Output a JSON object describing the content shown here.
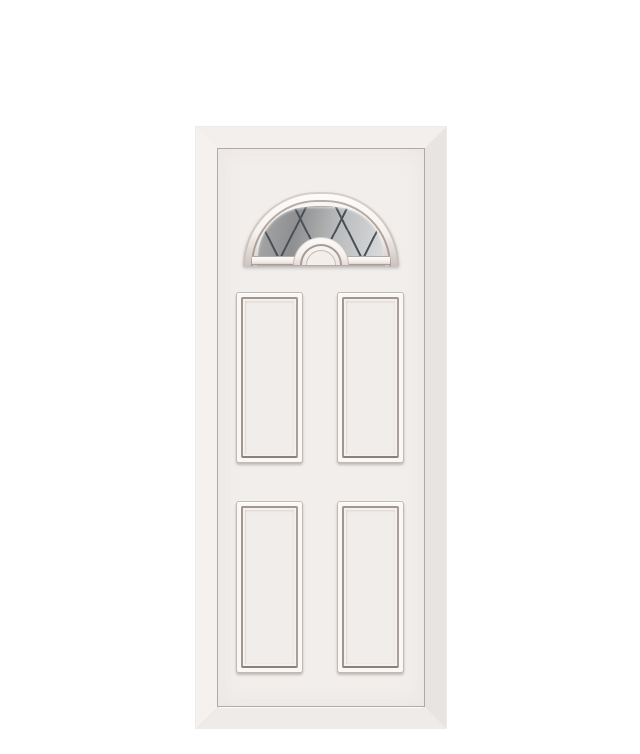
{
  "scene": {
    "type": "product image",
    "subject": "White panelled entrance door with half-moon fanlight",
    "background_color": "#ffffff"
  },
  "door": {
    "finish": "White",
    "panel_count": 4,
    "panel_layout": "2 columns x 2 rows of raised rectangular panels",
    "fanlight": {
      "shape": "half-moon sunburst arch",
      "glazing": "grey reflective glass with diamond lead lattice",
      "centre_detail": "half-round moulded hub at base"
    },
    "colors": {
      "background": "#ffffff",
      "frame-top": "#f2efed",
      "frame-left": "#f4f1ef",
      "frame-right": "#e8e4e2",
      "frame-bottom": "#efebe9",
      "leaf": "#f1eeec",
      "leaf-outline": "#b2a9a4",
      "moulding-light": "#faf8f7",
      "moulding-dark": "#a3968f",
      "moulding-shadow": "#8d8078",
      "panel-face": "#f1edeb",
      "arch-ring-taupe": "#a89b94",
      "arch-ring-white": "#f9f7f5",
      "glass-dark": "#a9a9aa",
      "glass-light": "#d9dbdc",
      "lead-line": "#4b5157"
    }
  }
}
